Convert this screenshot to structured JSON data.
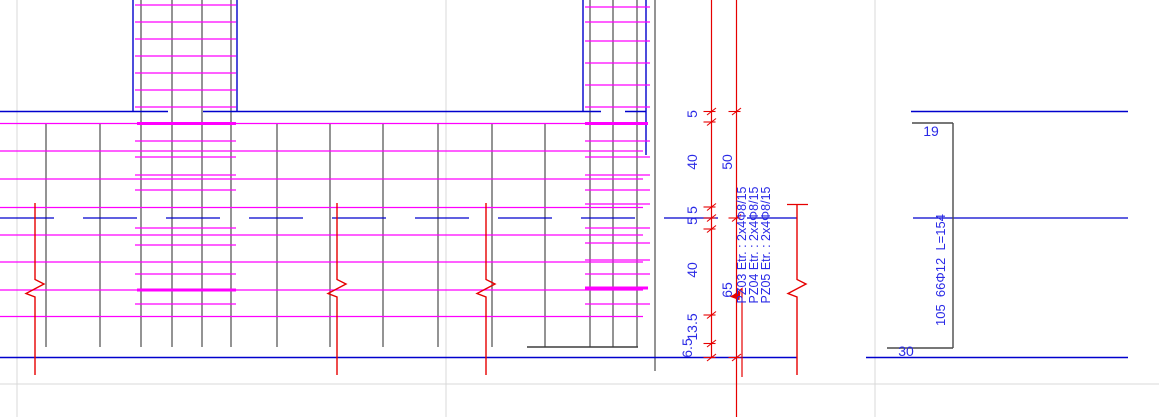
{
  "dimensions": {
    "chain_primary": [
      "5",
      "40",
      "5",
      "5",
      "40",
      "13.5",
      "6.5"
    ],
    "chain_secondary": [
      "50",
      "65"
    ]
  },
  "stirrup_labels": [
    "PZ03 Etr. : 2x4Φ8/15",
    "PZ04 Etr. : 2x4Φ8/15",
    "PZ05 Etr. : 2x4Φ8/15"
  ],
  "bar_detail": {
    "top_offset": "19",
    "bottom_offset": "30",
    "bar_text": "105  66Φ12  L=154"
  },
  "colors": {
    "rebar": "#ff00ff",
    "outline": "#0000cd",
    "dimension": "#e60000",
    "annotation": "#2a2ae6",
    "formwork": "#3d3d3d",
    "detail_bar": "#4a4a4a",
    "grid": "#d9d9d9"
  }
}
